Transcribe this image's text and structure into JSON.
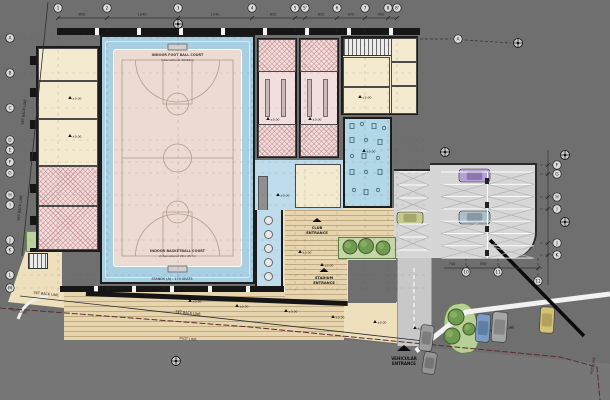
{
  "site": {
    "set_back_line": "SET BACK LINE",
    "plot_line": "PLOT LINE"
  },
  "courts": {
    "football_title": "INDOOR FOOT BALL COURT",
    "football_sub": "(International 40x22m)",
    "basketball_title": "INDOOR BASKETBALL COURT",
    "basketball_sub": "(International 28 x 15 m)",
    "stands_label": "STANDS (A) : 170 SEATS"
  },
  "entrances": {
    "club_line1": "CLUB",
    "club_line2": "ENTRANCE",
    "stadium_line1": "STADIUM",
    "stadium_line2": "ENTRANCE",
    "vehicular_line1": "VEHICULAR",
    "vehicular_line2": "ENTRANCE"
  },
  "grid": {
    "top": [
      {
        "l": "1",
        "x": 58
      },
      {
        "l": "2",
        "x": 107
      },
      {
        "l": "3",
        "x": 178
      },
      {
        "l": "4",
        "x": 252
      },
      {
        "l": "5",
        "x": 295
      },
      {
        "l": "5'",
        "x": 305
      },
      {
        "l": "6",
        "x": 337
      },
      {
        "l": "7",
        "x": 365
      },
      {
        "l": "8",
        "x": 388
      },
      {
        "l": "8'",
        "x": 397
      }
    ],
    "top_dims": [
      {
        "l": "850",
        "x": 82
      },
      {
        "l": "1240",
        "x": 142
      },
      {
        "l": "1240",
        "x": 215
      },
      {
        "l": "850",
        "x": 273
      },
      {
        "l": "650",
        "x": 321
      },
      {
        "l": "470",
        "x": 351
      },
      {
        "l": "450",
        "x": 381
      }
    ],
    "left": [
      {
        "l": "A",
        "y": 38
      },
      {
        "l": "B",
        "y": 73
      },
      {
        "l": "C",
        "y": 108
      },
      {
        "l": "D",
        "y": 140
      },
      {
        "l": "E",
        "y": 150
      },
      {
        "l": "F",
        "y": 162
      },
      {
        "l": "G",
        "y": 173
      },
      {
        "l": "H",
        "y": 195
      },
      {
        "l": "I",
        "y": 205
      },
      {
        "l": "J",
        "y": 240
      },
      {
        "l": "K",
        "y": 250
      },
      {
        "l": "L",
        "y": 275
      },
      {
        "l": "M",
        "y": 288
      }
    ],
    "right": [
      {
        "l": "F",
        "y": 165
      },
      {
        "l": "G",
        "y": 174
      },
      {
        "l": "H",
        "y": 197
      },
      {
        "l": "I",
        "y": 209
      },
      {
        "l": "J",
        "y": 243
      },
      {
        "l": "K",
        "y": 255
      }
    ],
    "bottom": [
      {
        "l": "10",
        "x": 466,
        "y": 272
      },
      {
        "l": "11",
        "x": 498,
        "y": 272
      },
      {
        "l": "11",
        "x": 538,
        "y": 281
      }
    ],
    "bottom_dims": [
      {
        "l": "740",
        "x": 452,
        "y": 265
      },
      {
        "l": "550",
        "x": 483,
        "y": 265
      }
    ],
    "extra": [
      {
        "l": "A",
        "x": 458,
        "y": 39
      }
    ]
  },
  "levels": [
    {
      "l": "±0.00",
      "x": 142,
      "y": 297
    },
    {
      "l": "±0.00",
      "x": 190,
      "y": 302
    },
    {
      "l": "±0.00",
      "x": 237,
      "y": 307
    },
    {
      "l": "±0.00",
      "x": 286,
      "y": 312
    },
    {
      "l": "±0.00",
      "x": 333,
      "y": 318
    },
    {
      "l": "±0.00",
      "x": 375,
      "y": 323
    },
    {
      "l": "±0.00",
      "x": 415,
      "y": 329
    },
    {
      "l": "±0.00",
      "x": 300,
      "y": 253
    },
    {
      "l": "±0.00",
      "x": 322,
      "y": 266
    },
    {
      "l": "±0.00",
      "x": 70,
      "y": 99
    },
    {
      "l": "±0.00",
      "x": 70,
      "y": 137
    },
    {
      "l": "±0.00",
      "x": 268,
      "y": 120
    },
    {
      "l": "±0.00",
      "x": 310,
      "y": 120
    },
    {
      "l": "±0.00",
      "x": 360,
      "y": 98
    },
    {
      "l": "±0.00",
      "x": 364,
      "y": 152
    },
    {
      "l": "±0.00",
      "x": 278,
      "y": 196
    }
  ],
  "annotations": {
    "setback_positions": [
      {
        "x": 25,
        "y": 112,
        "r": -84
      },
      {
        "x": 21,
        "y": 208,
        "r": -84
      },
      {
        "x": 46,
        "y": 295,
        "r": 6
      },
      {
        "x": 188,
        "y": 314,
        "r": 6
      },
      {
        "x": 502,
        "y": 330,
        "r": -8
      }
    ],
    "plot_positions": [
      {
        "x": 18,
        "y": 312,
        "r": 14
      },
      {
        "x": 188,
        "y": 340,
        "r": 5
      },
      {
        "x": 594,
        "y": 366,
        "r": -80
      }
    ],
    "section_markers": [
      {
        "x": 178,
        "y": 24
      },
      {
        "x": 518,
        "y": 43
      },
      {
        "x": 565,
        "y": 155
      },
      {
        "x": 565,
        "y": 222
      },
      {
        "x": 176,
        "y": 361
      },
      {
        "x": 445,
        "y": 152
      }
    ],
    "entry_triangles": [
      {
        "x": 404,
        "y": 351,
        "w": 14,
        "h": 6
      },
      {
        "x": 317,
        "y": 222,
        "w": 9,
        "h": 4
      },
      {
        "x": 324,
        "y": 272,
        "w": 9,
        "h": 4
      }
    ]
  },
  "landscape": {
    "trees": [
      {
        "x": 350,
        "y": 247,
        "r": 7
      },
      {
        "x": 366,
        "y": 246,
        "r": 7.5
      },
      {
        "x": 383,
        "y": 248,
        "r": 7
      },
      {
        "x": 456,
        "y": 317,
        "r": 8
      },
      {
        "x": 452,
        "y": 336,
        "r": 8
      },
      {
        "x": 469,
        "y": 329,
        "r": 6
      }
    ]
  },
  "vehicles": {
    "cars": [
      {
        "x": 459,
        "y": 169,
        "w": 31,
        "h": 13,
        "r": 0,
        "body": "#b6a0d6",
        "roof": "#8d77ad"
      },
      {
        "x": 459,
        "y": 211,
        "w": 31,
        "h": 13,
        "r": 0,
        "body": "#aebfc9",
        "roof": "#8799a5"
      },
      {
        "x": 397,
        "y": 212,
        "w": 26,
        "h": 12,
        "r": 0,
        "body": "#c6c98e",
        "roof": "#a3a66f"
      },
      {
        "x": 420,
        "y": 325,
        "w": 13,
        "h": 26,
        "r": 7,
        "body": "#9d9d9d",
        "roof": "#7d7d7d"
      },
      {
        "x": 423,
        "y": 352,
        "w": 13,
        "h": 22,
        "r": 9,
        "body": "#939393",
        "roof": "#757575"
      },
      {
        "x": 476,
        "y": 314,
        "w": 14,
        "h": 28,
        "r": 4,
        "body": "#7b9cc4",
        "roof": "#5f7ea3"
      },
      {
        "x": 492,
        "y": 312,
        "w": 15,
        "h": 30,
        "r": 4,
        "body": "#a6a6a6",
        "roof": "#868686"
      },
      {
        "x": 540,
        "y": 307,
        "w": 14,
        "h": 26,
        "r": 3,
        "body": "#d3c276",
        "roof": "#b1a25c"
      }
    ]
  },
  "colors": {
    "site_gray": "#6f6f6f",
    "plaza_beige": "#eee0bd",
    "track_blue": "#a9cfe2",
    "court_pink": "#ecdbd2",
    "room_cream": "#f4ead0",
    "locker_pink": "#f2dede",
    "gym_blue": "#b2d8e8",
    "lobby_blue": "#bfdcec",
    "parking_gray": "#d6d6d6",
    "wall_dark": "#1c1c1c",
    "tree_green": "#6f9a4f",
    "plot_line_red": "#5e2c2c"
  }
}
